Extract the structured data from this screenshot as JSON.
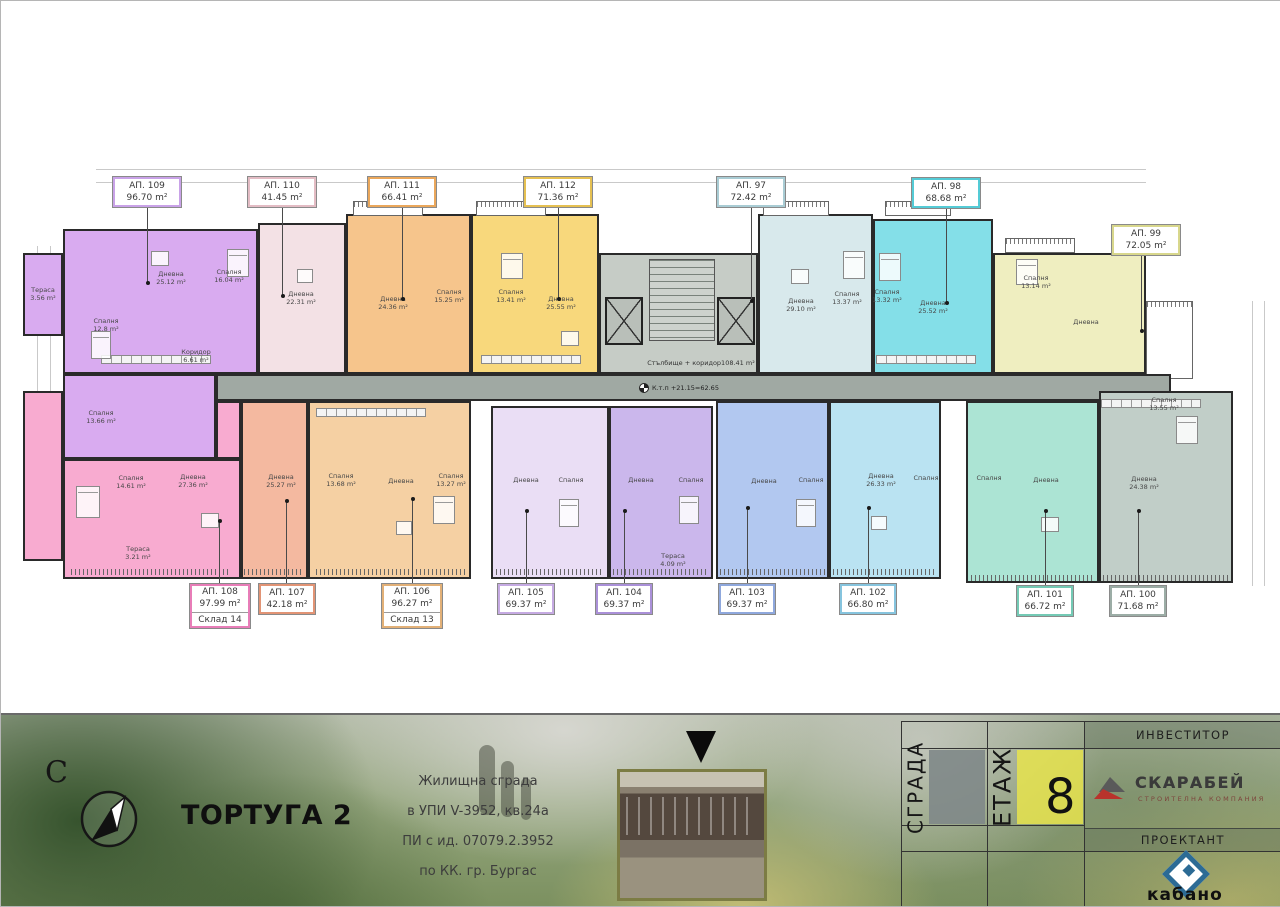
{
  "plan": {
    "corridor": {
      "name": "Стълбище + коридор",
      "area": "108.41 m²"
    },
    "level_mark": "К.т.п +21.15=62.65",
    "units": [
      {
        "id": "ap109",
        "label": "АП. 109",
        "area": "96.70 m²",
        "fill": "#d9abf0",
        "accent": "#c9a2e8",
        "rooms": [
          {
            "n": "Дневна",
            "a": "25.12 m²"
          },
          {
            "n": "Спалня",
            "a": "16.04 m²"
          },
          {
            "n": "Спалня",
            "a": "12.8 m²"
          },
          {
            "n": "Тераса",
            "a": "3.56 m²"
          },
          {
            "n": "Коридор",
            "a": "6.61 m²"
          }
        ]
      },
      {
        "id": "ap110",
        "label": "АП. 110",
        "area": "41.45 m²",
        "fill": "#f3e1e5",
        "accent": "#e3bcc4",
        "rooms": [
          {
            "n": "Дневна",
            "a": "22.31 m²"
          }
        ]
      },
      {
        "id": "ap111",
        "label": "АП. 111",
        "area": "66.41 m²",
        "fill": "#f6c58c",
        "accent": "#eaa75b",
        "rooms": [
          {
            "n": "Дневна",
            "a": "24.36 m²"
          },
          {
            "n": "Спалня",
            "a": "15.25 m²"
          }
        ]
      },
      {
        "id": "ap112",
        "label": "АП. 112",
        "area": "71.36 m²",
        "fill": "#f8d87c",
        "accent": "#e5c052",
        "rooms": [
          {
            "n": "Дневна",
            "a": "25.55 m²"
          },
          {
            "n": "Спалня",
            "a": "13.41 m²"
          }
        ]
      },
      {
        "id": "ap97",
        "label": "АП. 97",
        "area": "72.42 m²",
        "fill": "#d8e9ec",
        "accent": "#a9ccd4",
        "rooms": [
          {
            "n": "Дневна",
            "a": "29.10 m²"
          },
          {
            "n": "Спалня",
            "a": "13.37 m²"
          }
        ]
      },
      {
        "id": "ap98",
        "label": "АП. 98",
        "area": "68.68 m²",
        "fill": "#84dfe8",
        "accent": "#54cbd6",
        "rooms": [
          {
            "n": "Дневна",
            "a": "25.52 m²"
          },
          {
            "n": "Спалня",
            "a": "13.32 m²"
          }
        ]
      },
      {
        "id": "ap99",
        "label": "АП. 99",
        "area": "72.05 m²",
        "fill": "#efeec0",
        "accent": "#d8d78c",
        "rooms": [
          {
            "n": "Дневна",
            "a": ""
          },
          {
            "n": "Спалня",
            "a": "13.14 m²"
          }
        ]
      },
      {
        "id": "ap108",
        "label": "АП. 108",
        "area": "97.99 m²",
        "storage": "Склад 14",
        "fill": "#f8abd0",
        "accent": "#e87db8",
        "rooms": [
          {
            "n": "Дневна",
            "a": "27.36 m²"
          },
          {
            "n": "Спалня",
            "a": "14.61 m²"
          },
          {
            "n": "Спалня",
            "a": "13.66 m²"
          },
          {
            "n": "Тераса",
            "a": "3.21 m²"
          }
        ]
      },
      {
        "id": "ap107",
        "label": "АП. 107",
        "area": "42.18 m²",
        "fill": "#f4b9a0",
        "accent": "#e29475",
        "rooms": [
          {
            "n": "Дневна",
            "a": "25.27 m²"
          }
        ]
      },
      {
        "id": "ap106",
        "label": "АП. 106",
        "area": "96.27 m²",
        "storage": "Склад 13",
        "fill": "#f5d0a3",
        "accent": "#e2b077",
        "rooms": [
          {
            "n": "Дневна",
            "a": ""
          },
          {
            "n": "Спалня",
            "a": "13.68 m²"
          },
          {
            "n": "Спалня",
            "a": "13.27 m²"
          }
        ]
      },
      {
        "id": "ap105",
        "label": "АП. 105",
        "area": "69.37 m²",
        "fill": "#eadef5",
        "accent": "#c5aae2",
        "rooms": [
          {
            "n": "Дневна",
            "a": ""
          },
          {
            "n": "Спалня",
            "a": ""
          }
        ]
      },
      {
        "id": "ap104",
        "label": "АП. 104",
        "area": "69.37 m²",
        "fill": "#cbb7ec",
        "accent": "#aa90d8",
        "rooms": [
          {
            "n": "Дневна",
            "a": ""
          },
          {
            "n": "Спалня",
            "a": ""
          },
          {
            "n": "Тераса",
            "a": "4.09 m²"
          }
        ]
      },
      {
        "id": "ap103",
        "label": "АП. 103",
        "area": "69.37 m²",
        "fill": "#b2c8f0",
        "accent": "#8fa8dd",
        "rooms": [
          {
            "n": "Дневна",
            "a": ""
          },
          {
            "n": "Спалня",
            "a": ""
          }
        ]
      },
      {
        "id": "ap102",
        "label": "АП. 102",
        "area": "66.80 m²",
        "fill": "#bae3f2",
        "accent": "#86c4de",
        "rooms": [
          {
            "n": "Дневна",
            "a": "26.33 m²"
          },
          {
            "n": "Спалня",
            "a": ""
          }
        ]
      },
      {
        "id": "ap101",
        "label": "АП. 101",
        "area": "66.72 m²",
        "fill": "#ace4d4",
        "accent": "#74cab5",
        "rooms": [
          {
            "n": "Дневна",
            "a": ""
          },
          {
            "n": "Спалня",
            "a": ""
          }
        ]
      },
      {
        "id": "ap100",
        "label": "АП. 100",
        "area": "71.68 m²",
        "fill": "#c1cec8",
        "accent": "#9cada6",
        "rooms": [
          {
            "n": "Дневна",
            "a": "24.38 m²"
          },
          {
            "n": "Спалня",
            "a": "13.55 m²"
          }
        ]
      }
    ]
  },
  "footer": {
    "north": "С",
    "title": "ТОРТУГА 2",
    "address": [
      "Жилищна сграда",
      "в УПИ V-3952, кв.24а",
      "ПИ с ид. 07079.2.3952",
      "по КК. гр. Бургас"
    ],
    "table": {
      "building": "СГРАДА",
      "floor": "ЕТАЖ",
      "floor_value": "8",
      "investor": "ИНВЕСТИТОР",
      "investor_name": "СКАРАБЕЙ",
      "investor_sub": "СТРОИТЕЛНА КОМПАНИЯ",
      "designer": "ПРОЕКТАНТ",
      "designer_name": "кабано"
    }
  }
}
